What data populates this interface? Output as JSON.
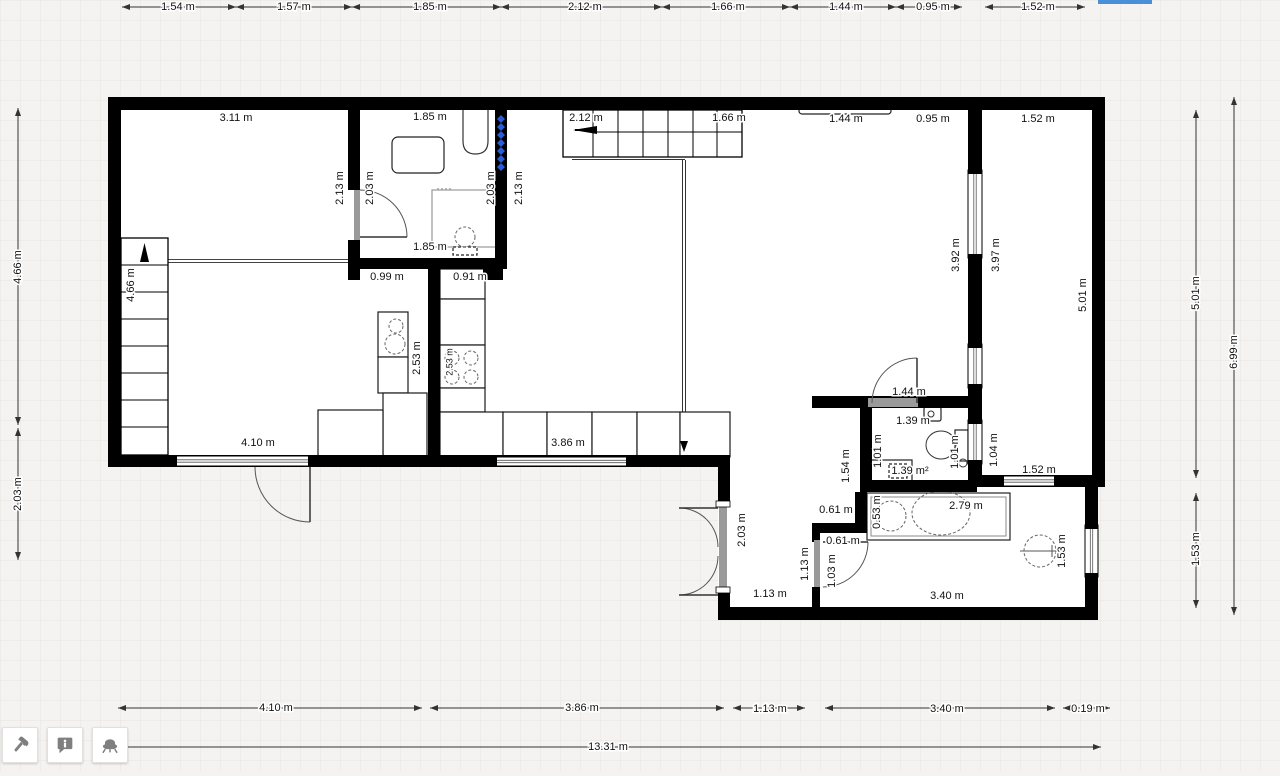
{
  "app": {
    "type": "floorplanner-canvas"
  },
  "colors": {
    "wall": "#000000",
    "grid_line": "#e7e5e1",
    "canvas_bg": "#f4f3f1",
    "building_fill": "#ffffff",
    "threshold_gray": "#9a9a9a",
    "selection_blue": "#2b5cd8",
    "top_selection_bar_blue": "#4a90d9",
    "icon_gray": "#7f7f7f",
    "dim_line": "#333333"
  },
  "toolbar": {
    "buttons": [
      {
        "name": "build-tool-button",
        "icon": "hammer-icon"
      },
      {
        "name": "annotation-tool-button",
        "icon": "info-bubble-icon"
      },
      {
        "name": "furniture-tool-button",
        "icon": "chair-icon"
      }
    ]
  },
  "selection_bar": {
    "x": 1098,
    "y": 0,
    "w": 54,
    "h": 4
  },
  "plan": {
    "canvas": {
      "w": 1280,
      "h": 771,
      "grid": 20
    },
    "building_outline": "108,97 1105,97 1105,487 1098,487 1098,620 718,620 718,467 108,467",
    "labels": [
      {
        "t": "1.54 m",
        "x": 178,
        "y": 7
      },
      {
        "t": "1.57 m",
        "x": 294,
        "y": 7
      },
      {
        "t": "1.85 m",
        "x": 430,
        "y": 7
      },
      {
        "t": "2.12 m",
        "x": 585,
        "y": 7
      },
      {
        "t": "1.66 m",
        "x": 728,
        "y": 7
      },
      {
        "t": "1.44 m",
        "x": 846,
        "y": 7
      },
      {
        "t": "0.95 m",
        "x": 933,
        "y": 7
      },
      {
        "t": "1.52 m",
        "x": 1038,
        "y": 7
      },
      {
        "t": "4.66 m",
        "x": 18,
        "y": 267,
        "r": 1
      },
      {
        "t": "2.03 m",
        "x": 18,
        "y": 494,
        "r": 1
      },
      {
        "t": "5.01 m",
        "x": 1196,
        "y": 293,
        "r": 1
      },
      {
        "t": "6.99 m",
        "x": 1234,
        "y": 352,
        "r": 1
      },
      {
        "t": "1.53 m",
        "x": 1196,
        "y": 549,
        "r": 1
      },
      {
        "t": "4.10 m",
        "x": 276,
        "y": 708
      },
      {
        "t": "3.86 m",
        "x": 582,
        "y": 708
      },
      {
        "t": "1.13 m",
        "x": 770,
        "y": 709
      },
      {
        "t": "3.40 m",
        "x": 947,
        "y": 709
      },
      {
        "t": "0.19 m",
        "x": 1088,
        "y": 709
      },
      {
        "t": "13.31 m",
        "x": 608,
        "y": 747
      },
      {
        "t": "3.11 m",
        "x": 236,
        "y": 118
      },
      {
        "t": "1.85 m",
        "x": 430,
        "y": 117
      },
      {
        "t": "2.12 m",
        "x": 586,
        "y": 118
      },
      {
        "t": "1.66 m",
        "x": 729,
        "y": 118
      },
      {
        "t": "1.44 m",
        "x": 846,
        "y": 119
      },
      {
        "t": "0.95 m",
        "x": 933,
        "y": 119
      },
      {
        "t": "1.52 m",
        "x": 1038,
        "y": 119
      },
      {
        "t": "2.13 m",
        "x": 340,
        "y": 188,
        "r": 1
      },
      {
        "t": "2.03 m",
        "x": 370,
        "y": 188,
        "r": 1
      },
      {
        "t": "2.03 m",
        "x": 491,
        "y": 188,
        "r": 1
      },
      {
        "t": "2.13 m",
        "x": 519,
        "y": 188,
        "r": 1
      },
      {
        "t": "1.85 m",
        "x": 430,
        "y": 247
      },
      {
        "t": "4.66 m",
        "x": 131,
        "y": 285,
        "r": 1
      },
      {
        "t": "0.99 m",
        "x": 387,
        "y": 277
      },
      {
        "t": "0.91 m",
        "x": 470,
        "y": 277
      },
      {
        "t": "2.53 m",
        "x": 417,
        "y": 358,
        "r": 1
      },
      {
        "t": "2.53 m",
        "x": 450,
        "y": 362,
        "r": 1,
        "s": 9
      },
      {
        "t": "3.92 m",
        "x": 956,
        "y": 255,
        "r": 1
      },
      {
        "t": "3.97 m",
        "x": 996,
        "y": 255,
        "r": 1
      },
      {
        "t": "5.01 m",
        "x": 1083,
        "y": 295,
        "r": 1
      },
      {
        "t": "4.10 m",
        "x": 258,
        "y": 443
      },
      {
        "t": "3.86 m",
        "x": 568,
        "y": 443
      },
      {
        "t": "1.44 m",
        "x": 909,
        "y": 392
      },
      {
        "t": "1.39 m",
        "x": 913,
        "y": 421
      },
      {
        "t": "1.01 m",
        "x": 878,
        "y": 451,
        "r": 1
      },
      {
        "t": "1.01 m",
        "x": 955,
        "y": 452,
        "r": 1
      },
      {
        "t": "1.04 m",
        "x": 994,
        "y": 450,
        "r": 1
      },
      {
        "t": "1.54 m",
        "x": 846,
        "y": 466,
        "r": 1
      },
      {
        "t": "1.39 m²",
        "x": 910,
        "y": 471
      },
      {
        "t": "1.52 m",
        "x": 1039,
        "y": 470
      },
      {
        "t": "2.79 m",
        "x": 966,
        "y": 506
      },
      {
        "t": "0.53 m",
        "x": 877,
        "y": 512,
        "r": 1
      },
      {
        "t": "0.61 m",
        "x": 836,
        "y": 510
      },
      {
        "t": "0.61 m",
        "x": 843,
        "y": 541
      },
      {
        "t": "2.03 m",
        "x": 742,
        "y": 530,
        "r": 1
      },
      {
        "t": "1.13 m",
        "x": 805,
        "y": 564,
        "r": 1
      },
      {
        "t": "1.03 m",
        "x": 832,
        "y": 571,
        "r": 1
      },
      {
        "t": "1.13 m",
        "x": 770,
        "y": 594
      },
      {
        "t": "3.40 m",
        "x": 947,
        "y": 596
      },
      {
        "t": "1.53 m",
        "x": 1062,
        "y": 551,
        "r": 1
      }
    ],
    "walls": [
      [
        108,
        97,
        997,
        13
      ],
      [
        108,
        110,
        13,
        357
      ],
      [
        108,
        455,
        610,
        12
      ],
      [
        718,
        455,
        12,
        50
      ],
      [
        718,
        589,
        12,
        31
      ],
      [
        718,
        607,
        380,
        13
      ],
      [
        1085,
        475,
        13,
        145
      ],
      [
        1092,
        110,
        13,
        377
      ],
      [
        977,
        475,
        128,
        12
      ],
      [
        348,
        110,
        12,
        80
      ],
      [
        348,
        240,
        12,
        40
      ],
      [
        495,
        110,
        12,
        159
      ],
      [
        348,
        258,
        159,
        11
      ],
      [
        428,
        268,
        12,
        189
      ],
      [
        483,
        268,
        20,
        12
      ],
      [
        968,
        110,
        14,
        286
      ],
      [
        968,
        396,
        14,
        84
      ],
      [
        812,
        396,
        165,
        12
      ],
      [
        860,
        408,
        12,
        84
      ],
      [
        860,
        480,
        117,
        12
      ],
      [
        812,
        523,
        43,
        10
      ],
      [
        855,
        492,
        12,
        41
      ],
      [
        812,
        533,
        8,
        9
      ],
      [
        812,
        587,
        8,
        20
      ]
    ],
    "windows": [
      [
        173,
        456,
        139,
        10,
        "h"
      ],
      [
        493,
        457,
        137,
        9,
        "h"
      ],
      [
        1000,
        476,
        58,
        10,
        "h"
      ],
      [
        968,
        170,
        14,
        88,
        "v"
      ],
      [
        968,
        344,
        14,
        44,
        "v"
      ],
      [
        968,
        420,
        14,
        44,
        "v"
      ],
      [
        1085,
        525,
        13,
        52,
        "v"
      ]
    ],
    "thresholds": [
      [
        354,
        190,
        6,
        50
      ],
      [
        868,
        398,
        50,
        9
      ],
      [
        719,
        505,
        8,
        86
      ],
      [
        814,
        540,
        6,
        47
      ]
    ],
    "caps": [
      [
        716,
        501,
        14,
        6
      ],
      [
        716,
        587,
        14,
        6
      ]
    ],
    "doors": [
      {
        "arc": "M 360 190 A 47 47 0 0 1 407 237",
        "leaf": [
          360,
          237,
          407,
          237
        ]
      },
      {
        "arc": "M 255 467 A 55 55 0 0 0 310 522",
        "leaf": [
          310,
          467,
          310,
          522
        ]
      },
      {
        "arc": "M 872 403 A 45 45 0 0 1 917 358",
        "leaf": [
          917,
          358,
          917,
          403
        ]
      },
      {
        "arc": "M 823 587 A 45 45 0 0 0 868 542",
        "leaf": [
          823,
          542,
          868,
          542
        ]
      },
      {
        "arc": "M 679 508 A 39 39 0 0 1 718 547",
        "leaf": [
          718,
          508,
          679,
          508
        ]
      },
      {
        "arc": "M 679 595 A 39 39 0 0 0 718 556",
        "leaf": [
          718,
          595,
          679,
          595
        ]
      }
    ],
    "stairs": [
      {
        "x": 563,
        "y": 110,
        "w": 179,
        "h": 47,
        "dir": "h",
        "treads": [
          593,
          618,
          643,
          668,
          693,
          717
        ],
        "mid": 132
      },
      {
        "x": 121,
        "y": 238,
        "w": 47,
        "h": 217,
        "dir": "v",
        "treads": [
          265,
          292,
          319,
          346,
          373,
          400,
          427
        ],
        "mid": null
      }
    ],
    "cabinets": [
      [
        378,
        312,
        30,
        45
      ],
      [
        378,
        357,
        30,
        36
      ],
      [
        383,
        393,
        44,
        64
      ],
      [
        318,
        410,
        65,
        47
      ],
      [
        440,
        269,
        45,
        30
      ],
      [
        440,
        299,
        45,
        46
      ],
      [
        440,
        345,
        45,
        43
      ],
      [
        440,
        388,
        45,
        24
      ],
      [
        440,
        412,
        63,
        45
      ],
      [
        503,
        412,
        44,
        45
      ],
      [
        547,
        412,
        45,
        45
      ],
      [
        592,
        412,
        45,
        45
      ],
      [
        637,
        412,
        43,
        45
      ],
      [
        680,
        412,
        50,
        45
      ]
    ],
    "fixture_rects": [
      {
        "x": 392,
        "y": 137,
        "w": 52,
        "h": 36,
        "rx": 6
      },
      {
        "x": 432,
        "y": 190,
        "w": 68,
        "h": 57,
        "st": "#999"
      },
      {
        "x": 453,
        "y": 247,
        "w": 24,
        "h": 8,
        "dash": 1
      },
      {
        "x": 799,
        "y": 106,
        "w": 92,
        "h": 8,
        "rx": 3
      },
      {
        "x": 866,
        "y": 460,
        "w": 46,
        "h": 22
      },
      {
        "x": 889,
        "y": 464,
        "w": 18,
        "h": 14,
        "dash": 1
      },
      {
        "x": 924,
        "y": 407,
        "w": 17,
        "h": 14,
        "rx": 2
      },
      {
        "x": 955,
        "y": 430,
        "w": 13,
        "h": 31
      },
      {
        "x": 867,
        "y": 493,
        "w": 143,
        "h": 47
      },
      {
        "x": 871,
        "y": 497,
        "w": 135,
        "h": 39,
        "st": "#888",
        "sw": 1
      }
    ],
    "circles_dashed": [
      [
        396,
        326,
        7
      ],
      [
        395,
        344,
        10
      ],
      [
        452,
        358,
        7
      ],
      [
        471,
        358,
        7
      ],
      [
        452,
        377,
        7
      ],
      [
        471,
        377,
        7
      ],
      [
        465,
        237,
        10
      ],
      [
        891,
        516,
        15
      ],
      [
        1040,
        551,
        16
      ]
    ],
    "circles_solid": [
      [
        931,
        414,
        3
      ],
      [
        963,
        463,
        4
      ]
    ],
    "ellipses": [
      {
        "cx": 941,
        "cy": 445,
        "rx": 15,
        "ry": 14
      },
      {
        "cx": 941,
        "cy": 513,
        "rx": 29,
        "ry": 22,
        "dash": 1
      }
    ],
    "paths": [
      {
        "d": "M 463 110 L 463 141 Q 463 154 475.5 154 Q 488 154 488 141 L 488 110",
        "st": "#333"
      }
    ],
    "lines": [
      [
        168,
        259.5,
        348,
        259.5,
        1,
        "#444"
      ],
      [
        168,
        262.5,
        348,
        262.5,
        1,
        "#444"
      ],
      [
        572,
        159.5,
        685,
        159.5,
        1,
        "#333"
      ],
      [
        682.5,
        160,
        682.5,
        444,
        1,
        "#333"
      ],
      [
        685.5,
        160,
        685.5,
        444,
        1,
        "#333"
      ],
      [
        144.5,
        448,
        144.5,
        258,
        1.2,
        "#000"
      ],
      [
        933,
        513,
        949,
        513,
        1,
        "#555"
      ],
      [
        941,
        505,
        941,
        521,
        1,
        "#555"
      ],
      [
        1020,
        551,
        1062,
        551,
        1,
        "#555"
      ],
      [
        1052,
        545,
        1052,
        557,
        1,
        "#555"
      ],
      [
        874,
        470,
        884,
        470,
        1.4,
        "#333"
      ],
      [
        879,
        465,
        879,
        475,
        1.4,
        "#333"
      ],
      [
        554,
        419,
        554,
        438,
        1.2,
        "#555"
      ],
      [
        438,
        188,
        438,
        193,
        1,
        "#777"
      ],
      [
        442,
        188,
        442,
        193,
        1,
        "#777"
      ],
      [
        446,
        188,
        446,
        193,
        1,
        "#777"
      ],
      [
        450,
        188,
        450,
        193,
        1,
        "#777"
      ]
    ],
    "radiator": {
      "x": 501,
      "y": 119,
      "n": 7,
      "step": 8,
      "size": 4
    },
    "arrows": [
      {
        "pts": "573,130 597,126 597,134"
      },
      {
        "pts": "144.5,243 140,262 149,262"
      },
      {
        "pts": "684,452 680,441 688,441"
      }
    ],
    "dims": [
      [
        122,
        7,
        236,
        7
      ],
      [
        236,
        7,
        352,
        7
      ],
      [
        352,
        7,
        501,
        7
      ],
      [
        501,
        7,
        662,
        7
      ],
      [
        662,
        7,
        790,
        7
      ],
      [
        790,
        7,
        896,
        7
      ],
      [
        896,
        7,
        962,
        7
      ],
      [
        985,
        7,
        1085,
        7
      ],
      [
        18,
        108,
        18,
        425
      ],
      [
        18,
        428,
        18,
        560
      ],
      [
        1196,
        110,
        1196,
        478
      ],
      [
        1196,
        493,
        1196,
        608
      ],
      [
        1234,
        97,
        1234,
        615
      ],
      [
        118,
        708,
        422,
        708
      ],
      [
        430,
        708,
        724,
        708
      ],
      [
        733,
        708,
        805,
        708
      ],
      [
        825,
        708,
        1055,
        708
      ],
      [
        1063,
        708,
        1110,
        708
      ],
      [
        118,
        747,
        1101,
        747
      ]
    ]
  }
}
